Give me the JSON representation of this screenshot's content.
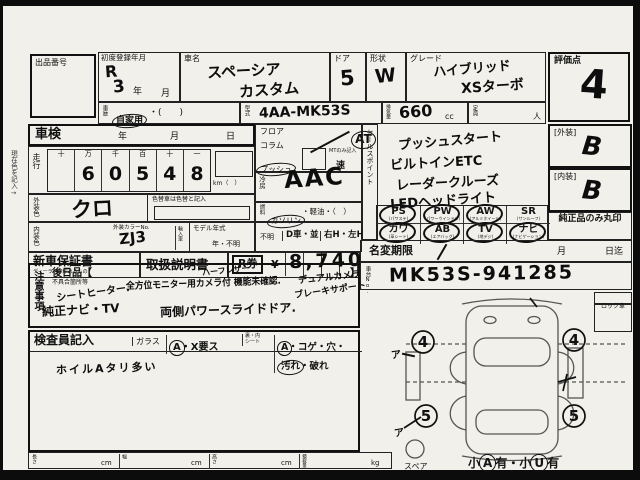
{
  "frame": {
    "margin_note": "現在色を記入→"
  },
  "top": {
    "lot_label": "出品番号",
    "reg_label": "初度登録年月",
    "reg_era": "R",
    "reg_year": "3",
    "reg_year_suffix": "年",
    "reg_month_suffix": "月",
    "name_label": "車名",
    "name1": "スペーシア",
    "name2": "カスタム",
    "door_label": "ドア",
    "door": "5",
    "shape_label": "形状",
    "shape": "W",
    "grade_label": "グレード",
    "grade1": "ハイブリッド",
    "grade2": "XSターボ",
    "score_label": "評価点",
    "score": "4",
    "hist_label": "車歴",
    "hist_main": "自家用",
    "hist_rest": "・(　　)",
    "model_label": "型式",
    "model": "4AA-MK53S",
    "disp_label": "排気量",
    "disp": "660",
    "disp_unit": "cc",
    "cap_label": "定員",
    "cap_unit": "人"
  },
  "left": {
    "shaken_label": "車検",
    "y": "年",
    "m": "月",
    "d": "日",
    "run_label": "走行",
    "run_headers": [
      "十",
      "万",
      "千",
      "百",
      "十",
      "一"
    ],
    "run_digits": [
      "",
      "6",
      "0",
      "5",
      "4",
      "8"
    ],
    "km_label": "km（　）",
    "color_change_note": "色替車は色替と記入",
    "ext_label": "外装色",
    "ext_value": "クロ",
    "int_label": "内装色",
    "colorno_label": "外装カラーNo.",
    "colorno": "ZJ3",
    "import_label": "輸入車",
    "modelyear_label": "モデル年式",
    "modelyear": "年・不明"
  },
  "mid": {
    "shift_opt1": "フロア",
    "shift_opt2": "コラム",
    "shift_opt3": "プッシュ",
    "at": "AT",
    "mt_note": "MTのみ記入",
    "mt_unit": "速",
    "ac_label": "冷房",
    "ac_value": "AAC",
    "fuel_label": "燃料",
    "fuel_gas": "ガソリン",
    "fuel_rest": "・軽油・（　）",
    "unknown": "不明",
    "dcar": "D車・並",
    "handle": "右H・左H"
  },
  "sales": {
    "label": "セールスポイント",
    "line1": "プッシュスタート",
    "line2": "ビルトインETC",
    "line3": "レーダークルーズ",
    "line4": "LEDヘッドライト"
  },
  "equipment": {
    "items": [
      {
        "code": "PS",
        "sub": "(パワステ)",
        "circled": true
      },
      {
        "code": "PW",
        "sub": "(パワーウインドウ)",
        "circled": true
      },
      {
        "code": "AW",
        "sub": "(アルミホイール)",
        "circled": true
      },
      {
        "code": "SR",
        "sub": "(サンルーフ)",
        "circled": false
      },
      {
        "code": "カワ",
        "sub": "(革シート)",
        "circled": true
      },
      {
        "code": "AB",
        "sub": "(エアバッグ)",
        "circled": true
      },
      {
        "code": "TV",
        "sub": "(地デジ)",
        "circled": true
      },
      {
        "code": "ナビ",
        "sub": "(ナビゲーション)",
        "circled": true
      }
    ]
  },
  "ratings": {
    "ext_label": "[外装]",
    "ext": "B",
    "int_label": "[内装]",
    "int": "B",
    "genuine": "純正品のみ丸印"
  },
  "docs": {
    "warranty": "新車保証書",
    "warranty_sub": "ディーラー捺印あるもの",
    "manual": "取扱説明書",
    "rticket": "R券",
    "yen": "¥",
    "fee": "8,740"
  },
  "notes": {
    "label": "注意事項",
    "later": "後日品【",
    "later_close": "】",
    "defect_label": "不具合箇所等",
    "hw_top": "ハーフレザー",
    "hw1a": "シートヒーター.",
    "hw1b": "全方位モニター用カメラ付 機能未確認.",
    "hw1c": "デュアルカメラ",
    "hw1d": "ブレーキサポート",
    "hw2a": "純正ナビ・TV",
    "hw2b": "両側パワースライドドア."
  },
  "inspector": {
    "title": "検査員記入",
    "glass_label": "ガラス",
    "glass_a": "A",
    "glass_rest": "・X要ス",
    "seat_label1": "裏・内",
    "seat_label2": "シート",
    "seat_a": "A",
    "seat_mid": "・コゲ・穴・",
    "seat_dirt": "汚れ",
    "seat_rest": "・破れ",
    "hw": "ホイルAタリ多い"
  },
  "dims": {
    "len": "長さ",
    "wid": "幅",
    "hei": "高さ",
    "load": "積載量",
    "cm": "cm",
    "kg": "kg"
  },
  "right": {
    "namechange_label": "名変期限",
    "nc_month": "月",
    "nc_until": "日迄",
    "chassis_label": "車台No.",
    "chassis": "MK53S-941285",
    "lock": "ロック車",
    "wheel_fl": "4",
    "wheel_fr": "4",
    "wheel_rl": "5",
    "wheel_rr": "5",
    "spare": "スペア",
    "note_s1": "小",
    "note_a": "A",
    "note_s2": "有・小",
    "note_u": "U",
    "note_s3": "有",
    "mark1": "ア",
    "mark2": "ア"
  }
}
